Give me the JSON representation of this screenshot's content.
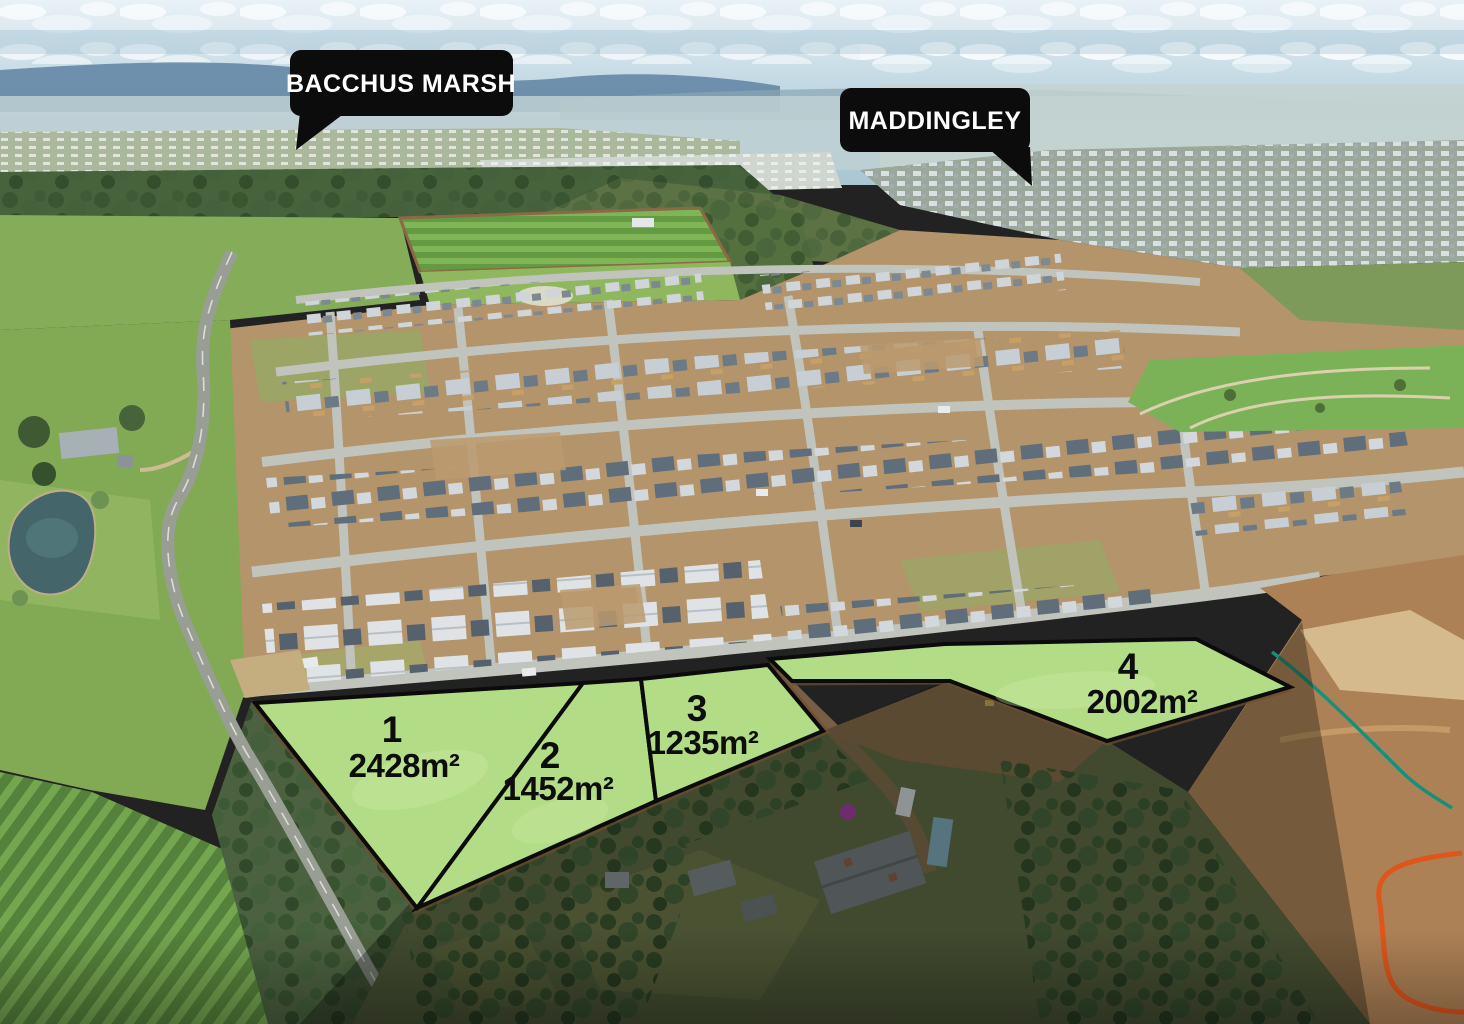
{
  "callouts": [
    {
      "id": "bacchus-marsh",
      "label": "BACCHUS MARSH"
    },
    {
      "id": "maddingley",
      "label": "MADDINGLEY"
    }
  ],
  "lots": [
    {
      "number": "1",
      "area": "2428m²"
    },
    {
      "number": "2",
      "area": "1452m²"
    },
    {
      "number": "3",
      "area": "1235m²"
    },
    {
      "number": "4",
      "area": "2002m²"
    }
  ],
  "colors": {
    "lot_fill": "#b3dc86",
    "lot_stroke": "#0b0b0b",
    "label_text": "#0d0d0d",
    "callout_bg": "#0c0c0c",
    "callout_text": "#ffffff"
  }
}
